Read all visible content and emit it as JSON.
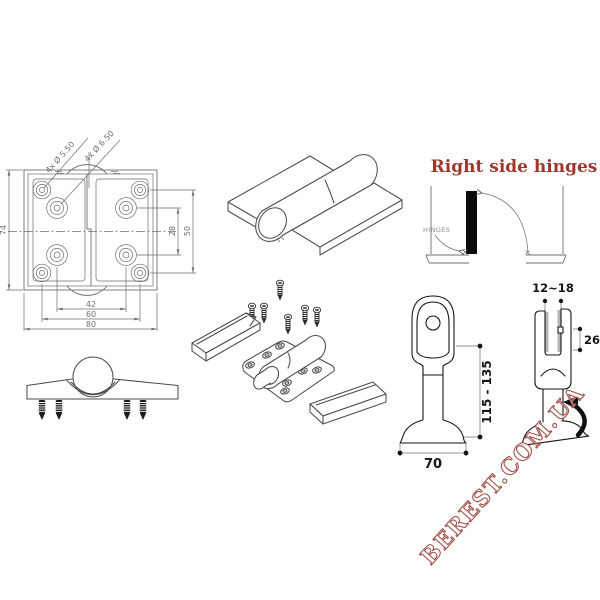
{
  "colors": {
    "line_gray": "#6f6f6f",
    "sketch_gray": "#4c4c4c",
    "dim_black": "#161616",
    "black": "#0b0b0b",
    "label_gray": "#8f8f8f",
    "title_red": "#9f362e",
    "watermark_red": "#a14e48"
  },
  "hinge_top_view": {
    "labels": {
      "holes_small": "4x Ø 5.50",
      "holes_large": "4x Ø 6.50",
      "plate_height": "74",
      "hole_span_vertical_inner": "28",
      "hole_span_vertical_outer": "50",
      "hole_span_horizontal_inner": "42",
      "hole_span_horizontal_outer": "60",
      "plate_width": "80"
    }
  },
  "door_swing": {
    "title": "Right side hinges",
    "hinges_label": "HINGES"
  },
  "door_leg": {
    "height_range": "115 - 135",
    "base_width": "70"
  },
  "glass_clamp": {
    "glass_thickness_range": "12~18",
    "jaw_depth": "26"
  },
  "watermark": {
    "text": "BEREST.COM.UA"
  }
}
